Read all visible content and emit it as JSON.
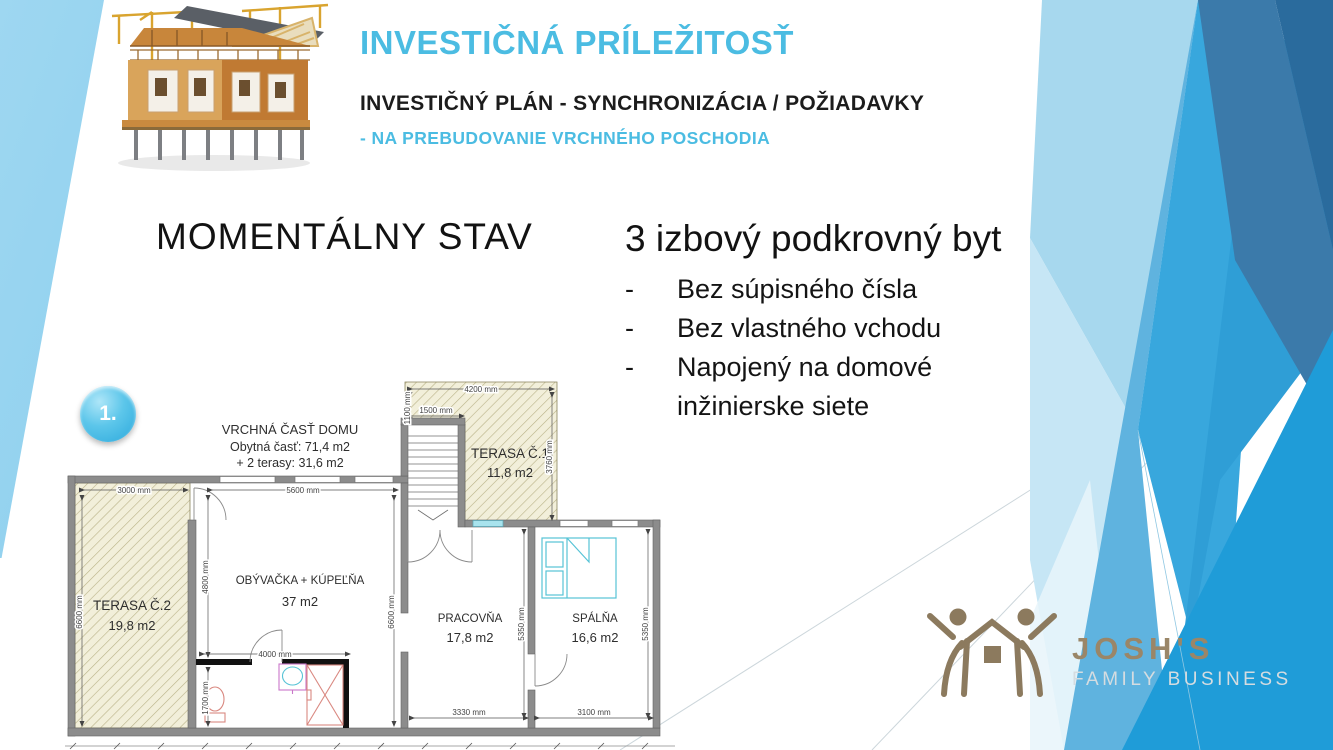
{
  "slide": {
    "title": "INVESTIČNÁ PRÍLEŽITOSŤ",
    "subtitle": "INVESTIČNÝ PLÁN - SYNCHRONIZÁCIA / POŽIADAVKY",
    "subtitle2": "- NA PREBUDOVANIE VRCHNÉHO POSCHODIA"
  },
  "section": {
    "heading": "MOMENTÁLNY STAV"
  },
  "apartment": {
    "heading": "3 izbový podkrovný byt",
    "bullet_marker": "-",
    "bullets": [
      "Bez súpisného čísla",
      "Bez vlastného vchodu",
      "Napojený na domové inžinierske siete"
    ]
  },
  "badge": {
    "label": "1."
  },
  "floorplan": {
    "header": {
      "line1": "VRCHNÁ ČASŤ DOMU",
      "line2": "Obytná časť: 71,4 m2",
      "line3": "+ 2 terasy: 31,6 m2"
    },
    "rooms": {
      "terasa1": {
        "name": "TERASA Č.1",
        "area": "11,8 m2"
      },
      "terasa2": {
        "name": "TERASA Č.2",
        "area": "19,8 m2"
      },
      "obyvacka": {
        "name": "OBÝVAČKA + KÚPEĽŇA",
        "area": "37 m2"
      },
      "pracovna": {
        "name": "PRACOVŇA",
        "area": "17,8 m2"
      },
      "spalna": {
        "name": "SPÁLŇA",
        "area": "16,6 m2"
      }
    },
    "dims": {
      "terasa2_top": "3000 mm",
      "living_top": "5600 mm",
      "left": "6600 mm",
      "living_right": "6600 mm",
      "living_left_inner": "4800 mm",
      "bath_top": "4000 mm",
      "bath_left": "1700 mm",
      "terasa1_top": "4200 mm",
      "terasa1_left": "1100 mm",
      "stair_top": "1500 mm",
      "terasa1_right": "3760 mm",
      "pracovna_right": "5350 mm",
      "spalna_right": "5350 mm",
      "pracovna_bottom": "3330 mm",
      "spalna_bottom": "3100 mm"
    }
  },
  "logo": {
    "name": "JOSH'S",
    "tagline": "FAMILY BUSINESS"
  },
  "colors": {
    "accent_cyan": "#4bbce2",
    "facet_bright_blue": "#1f9cd8",
    "facet_light_blue": "#a7d8ee",
    "facet_dark_blue": "#3b7aaa",
    "logo_brown": "#8c7a5e"
  }
}
